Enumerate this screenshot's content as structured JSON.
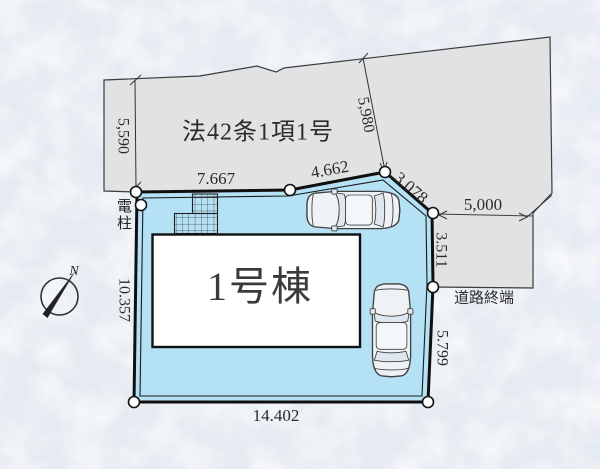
{
  "colors": {
    "background": "#e6ebf2",
    "road_fill": "#e1e2e4",
    "lot_fill": "#b5e1f5",
    "building_fill": "#ffffff",
    "line": "#2b2b2b"
  },
  "road": {
    "law_label": "法42条1項1号",
    "terminus_label": "道路終端"
  },
  "building": {
    "name": "1号棟"
  },
  "labels": {
    "utility_pole": "電柱"
  },
  "compass": {
    "north_label": "N"
  },
  "dimensions": {
    "road_width_left": "5,590",
    "road_width_upper_right": "5,980",
    "road_width_terminus": "5,000",
    "lot_top": "7.667",
    "lot_top_right": "4.662",
    "lot_corner_ne": "3.078",
    "lot_right_upper": "3.511",
    "lot_right_lower": "5.799",
    "lot_left": "10.357",
    "lot_bottom": "14.402"
  }
}
